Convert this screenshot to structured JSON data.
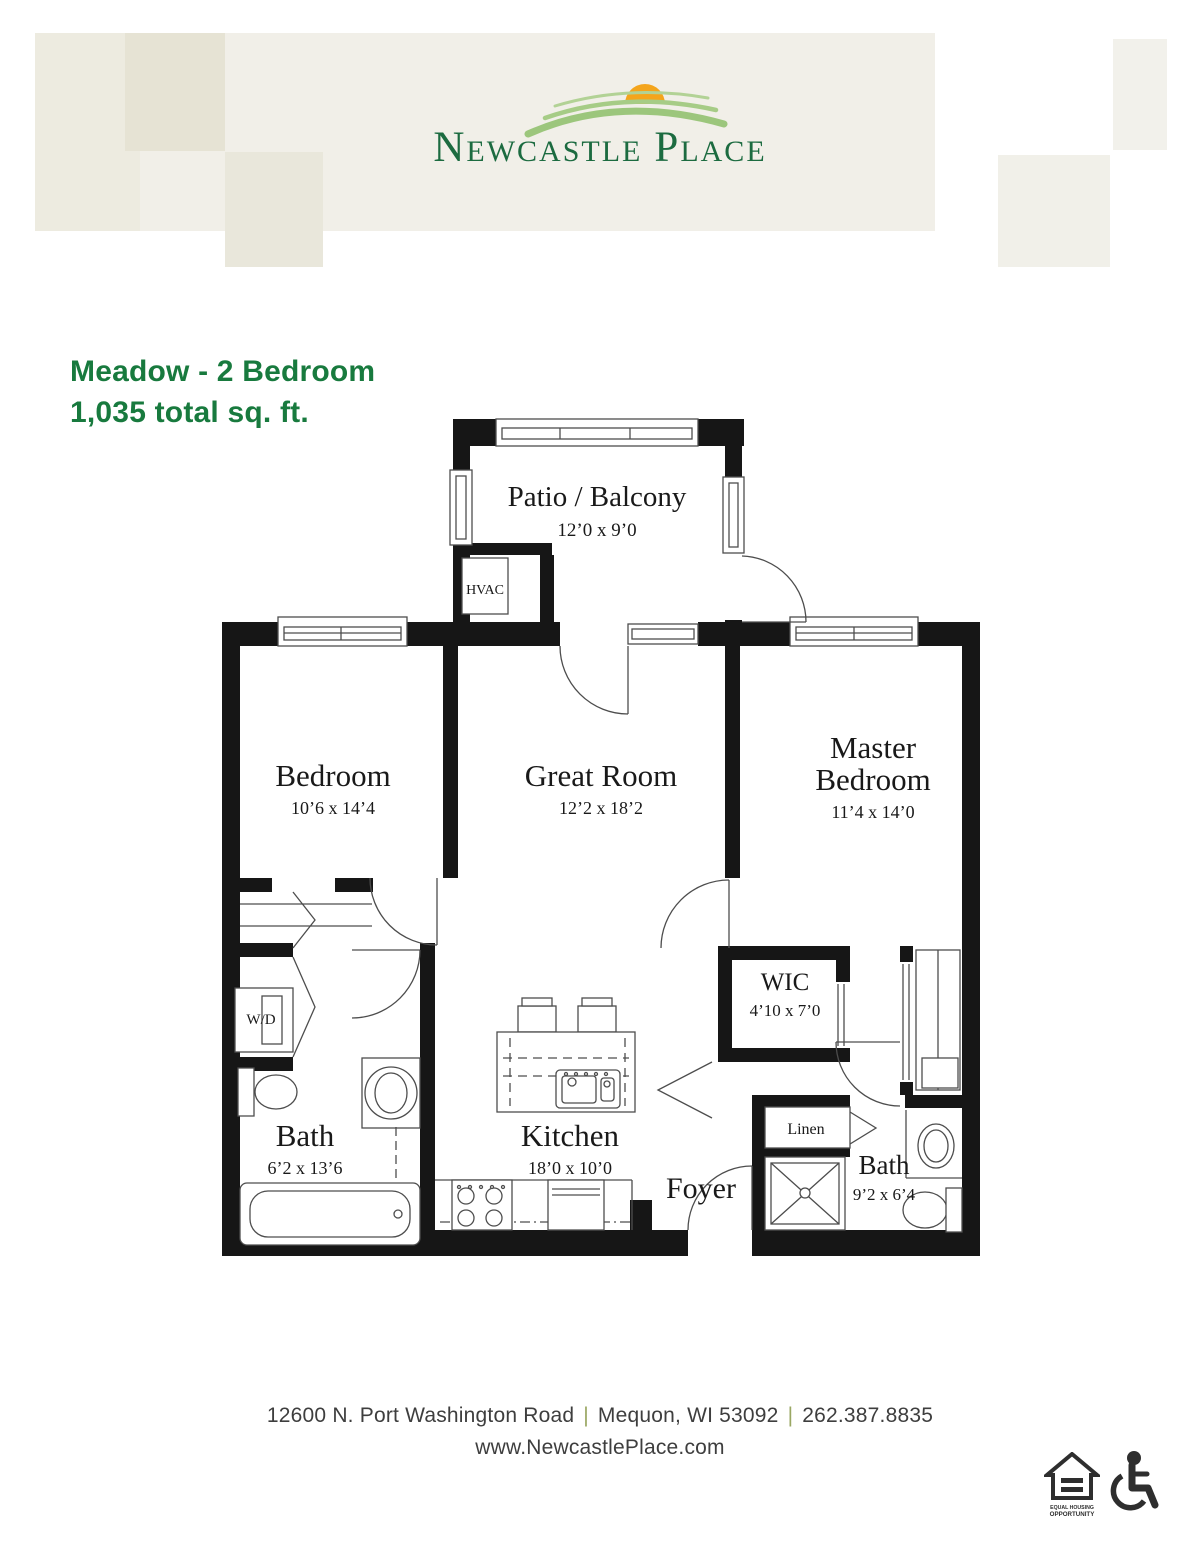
{
  "logo": {
    "word_initial_1": "N",
    "word_rest_1": "EWCASTLE",
    "word_initial_2": "P",
    "word_rest_2": "LACE"
  },
  "title": {
    "line1": "Meadow - 2 Bedroom",
    "line2": "1,035 total sq. ft."
  },
  "plan": {
    "patio": {
      "label": "Patio / Balcony",
      "dims": "12’0 x 9’0"
    },
    "hvac_label": "HVAC",
    "bedroom": {
      "label": "Bedroom",
      "dims": "10’6 x 14’4"
    },
    "great_room": {
      "label": "Great Room",
      "dims": "12’2 x 18’2"
    },
    "master_bedroom": {
      "label_line1": "Master",
      "label_line2": "Bedroom",
      "dims": "11’4 x 14’0"
    },
    "wic": {
      "label": "WIC",
      "dims": "4’10 x 7’0"
    },
    "washer_dryer_label": "W/D",
    "bath": {
      "label": "Bath",
      "dims": "6’2 x 13’6"
    },
    "kitchen": {
      "label": "Kitchen",
      "dims": "18’0 x 10’0"
    },
    "foyer_label": "Foyer",
    "linen_label": "Linen",
    "master_bath": {
      "label": "Bath",
      "dims": "9’2 x 6’4"
    }
  },
  "footer": {
    "address": "12600 N. Port Washington Road",
    "city_state_zip": "Mequon, WI 53092",
    "phone": "262.387.8835",
    "separator": "|",
    "website": "www.NewcastlePlace.com",
    "equal_housing_line1": "EQUAL HOUSING",
    "equal_housing_line2": "OPPORTUNITY"
  },
  "icons": {
    "equal_housing_icon": "house-with-equals",
    "wheelchair_icon": "wheelchair-accessible"
  },
  "colors": {
    "brand_green": "#1c6b40",
    "title_green": "#187a3e",
    "sun_orange": "#f4a51c",
    "hill_green": "#a6cc86",
    "separator_olive": "#9aa763",
    "footer_text": "#3e3e3e",
    "wall_black": "#161616",
    "header_beige": "#f1efe8"
  }
}
